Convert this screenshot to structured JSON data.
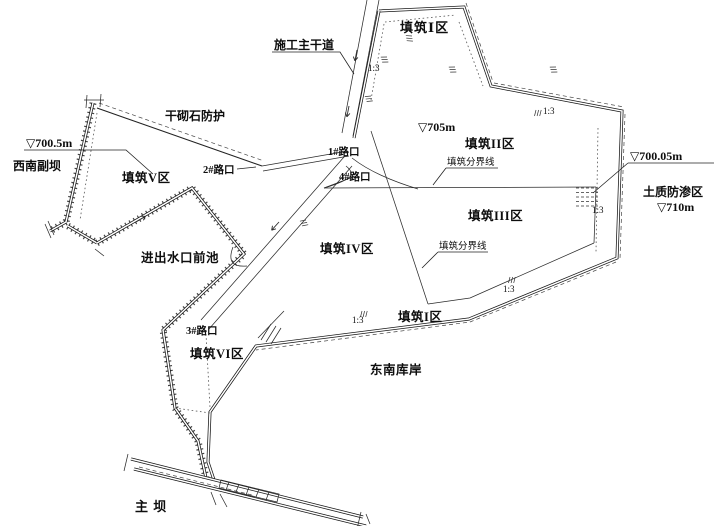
{
  "diagram": {
    "type": "construction-site-zoning-plan",
    "colors": {
      "line": "#141414",
      "background": "#ffffff"
    }
  },
  "labels": {
    "main_road": "施工主干道",
    "zone1_top": "填筑Ⅰ区",
    "dry_masonry": "干砌石防护",
    "elev_700_5": "▽700.5m",
    "sw_dam": "西南副坝",
    "zone5": "填筑V区",
    "junction2": "2#路口",
    "junction1": "1#路口",
    "junction4": "4#路口",
    "elev_705": "▽705m",
    "zone2": "填筑II区",
    "boundary_line_1": "填筑分界线",
    "zone3": "填筑III区",
    "elev_700_05": "▽700.05m",
    "seepage_zone": "土质防渗区",
    "elev_710": "▽710m",
    "forebay": "进出水口前池",
    "zone4": "填筑IV区",
    "boundary_line_2": "填筑分界线",
    "junction3": "3#路口",
    "zone6": "填筑VI区",
    "zone1_low": "填筑I区",
    "se_bank": "东南库岸",
    "main_dam": "主  坝",
    "slope": "1:3"
  }
}
